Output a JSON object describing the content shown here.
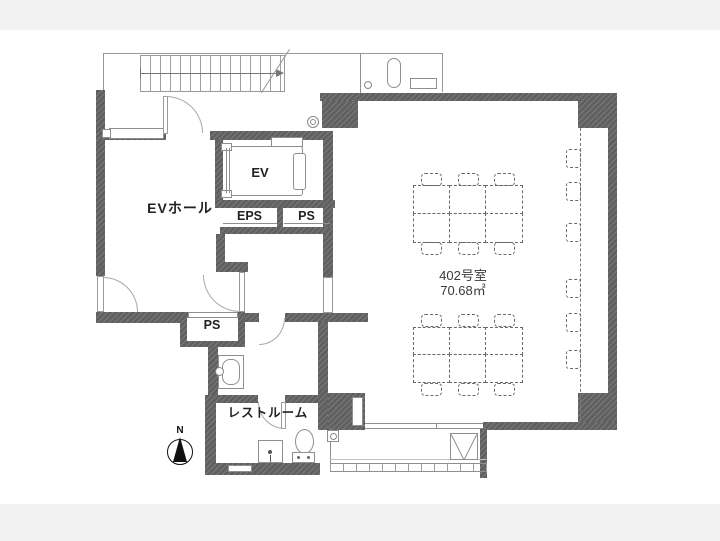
{
  "meta": {
    "type": "floor-plan",
    "description": "Japanese office floor plan of unit 402 with elevator hall, elevator, pipe shafts, restroom, main room with dashed furniture layout and balcony",
    "orientation": "north-up"
  },
  "colors": {
    "page_bg": "#f2f2f3",
    "canvas_bg": "#ffffff",
    "wall": "#606060",
    "thin_line": "#8f8f8f",
    "dash": "#6a6a6a",
    "text": "#222222"
  },
  "labels": {
    "ev_hall": "EVホール",
    "ev": "EV",
    "eps": "EPS",
    "ps_upper": "PS",
    "ps_lower": "PS",
    "restroom": "レストルーム",
    "room_number": "402号室",
    "room_area": "70.68㎡",
    "north": "N"
  },
  "unit": {
    "number": "402号室",
    "floor_area": "70.68㎡"
  },
  "rooms": [
    {
      "id": "ev_hall",
      "label": "EVホール"
    },
    {
      "id": "elevator",
      "label": "EV"
    },
    {
      "id": "eps_shaft",
      "label": "EPS"
    },
    {
      "id": "ps_shaft_upper",
      "label": "PS"
    },
    {
      "id": "ps_shaft_lower",
      "label": "PS"
    },
    {
      "id": "restroom",
      "label": "レストルーム"
    },
    {
      "id": "main_room",
      "label": "402号室",
      "area": "70.68㎡"
    }
  ]
}
